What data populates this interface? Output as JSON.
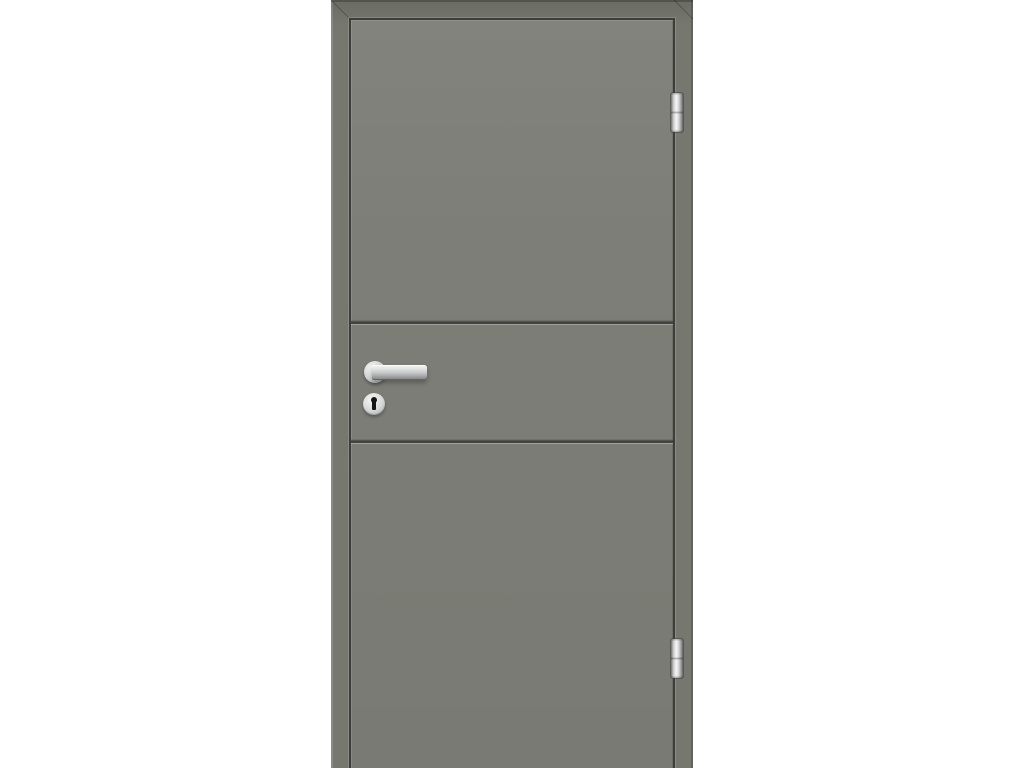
{
  "scene": {
    "type": "product-photo",
    "description": "Grey interior door with matching frame, two horizontal grooves dividing the leaf into three panels, stainless-steel lever handle on a round rosette, round keyhole escutcheon below the handle, and two barrel hinges on the right edge, photographed on a plain white background",
    "labels": {
      "photo": "Interior door product photo",
      "frame": "Door frame",
      "gap": "Rebate gap between leaf and frame",
      "leaf": "Door leaf",
      "groove_upper": "Upper horizontal groove",
      "groove_lower": "Lower horizontal groove",
      "rosette": "Handle rosette",
      "handle": "Stainless steel lever handle",
      "escutcheon": "Keyhole escutcheon",
      "keyhole": "Keyhole",
      "hinge_top": "Top hinge",
      "hinge_bottom": "Bottom hinge",
      "miter_top_left": "Frame corner joint top left",
      "miter_top_right": "Frame corner joint top right"
    }
  },
  "colors": {
    "background": "#ffffff",
    "frame": "#76776f",
    "leaf": "#7d7e77",
    "gap": "#3d3e39",
    "groove": "#43443f",
    "metal_light": "#f5f5f5",
    "metal_mid": "#c3c4c5",
    "metal_dark": "#6f6f6f",
    "keyhole": "#151515"
  }
}
